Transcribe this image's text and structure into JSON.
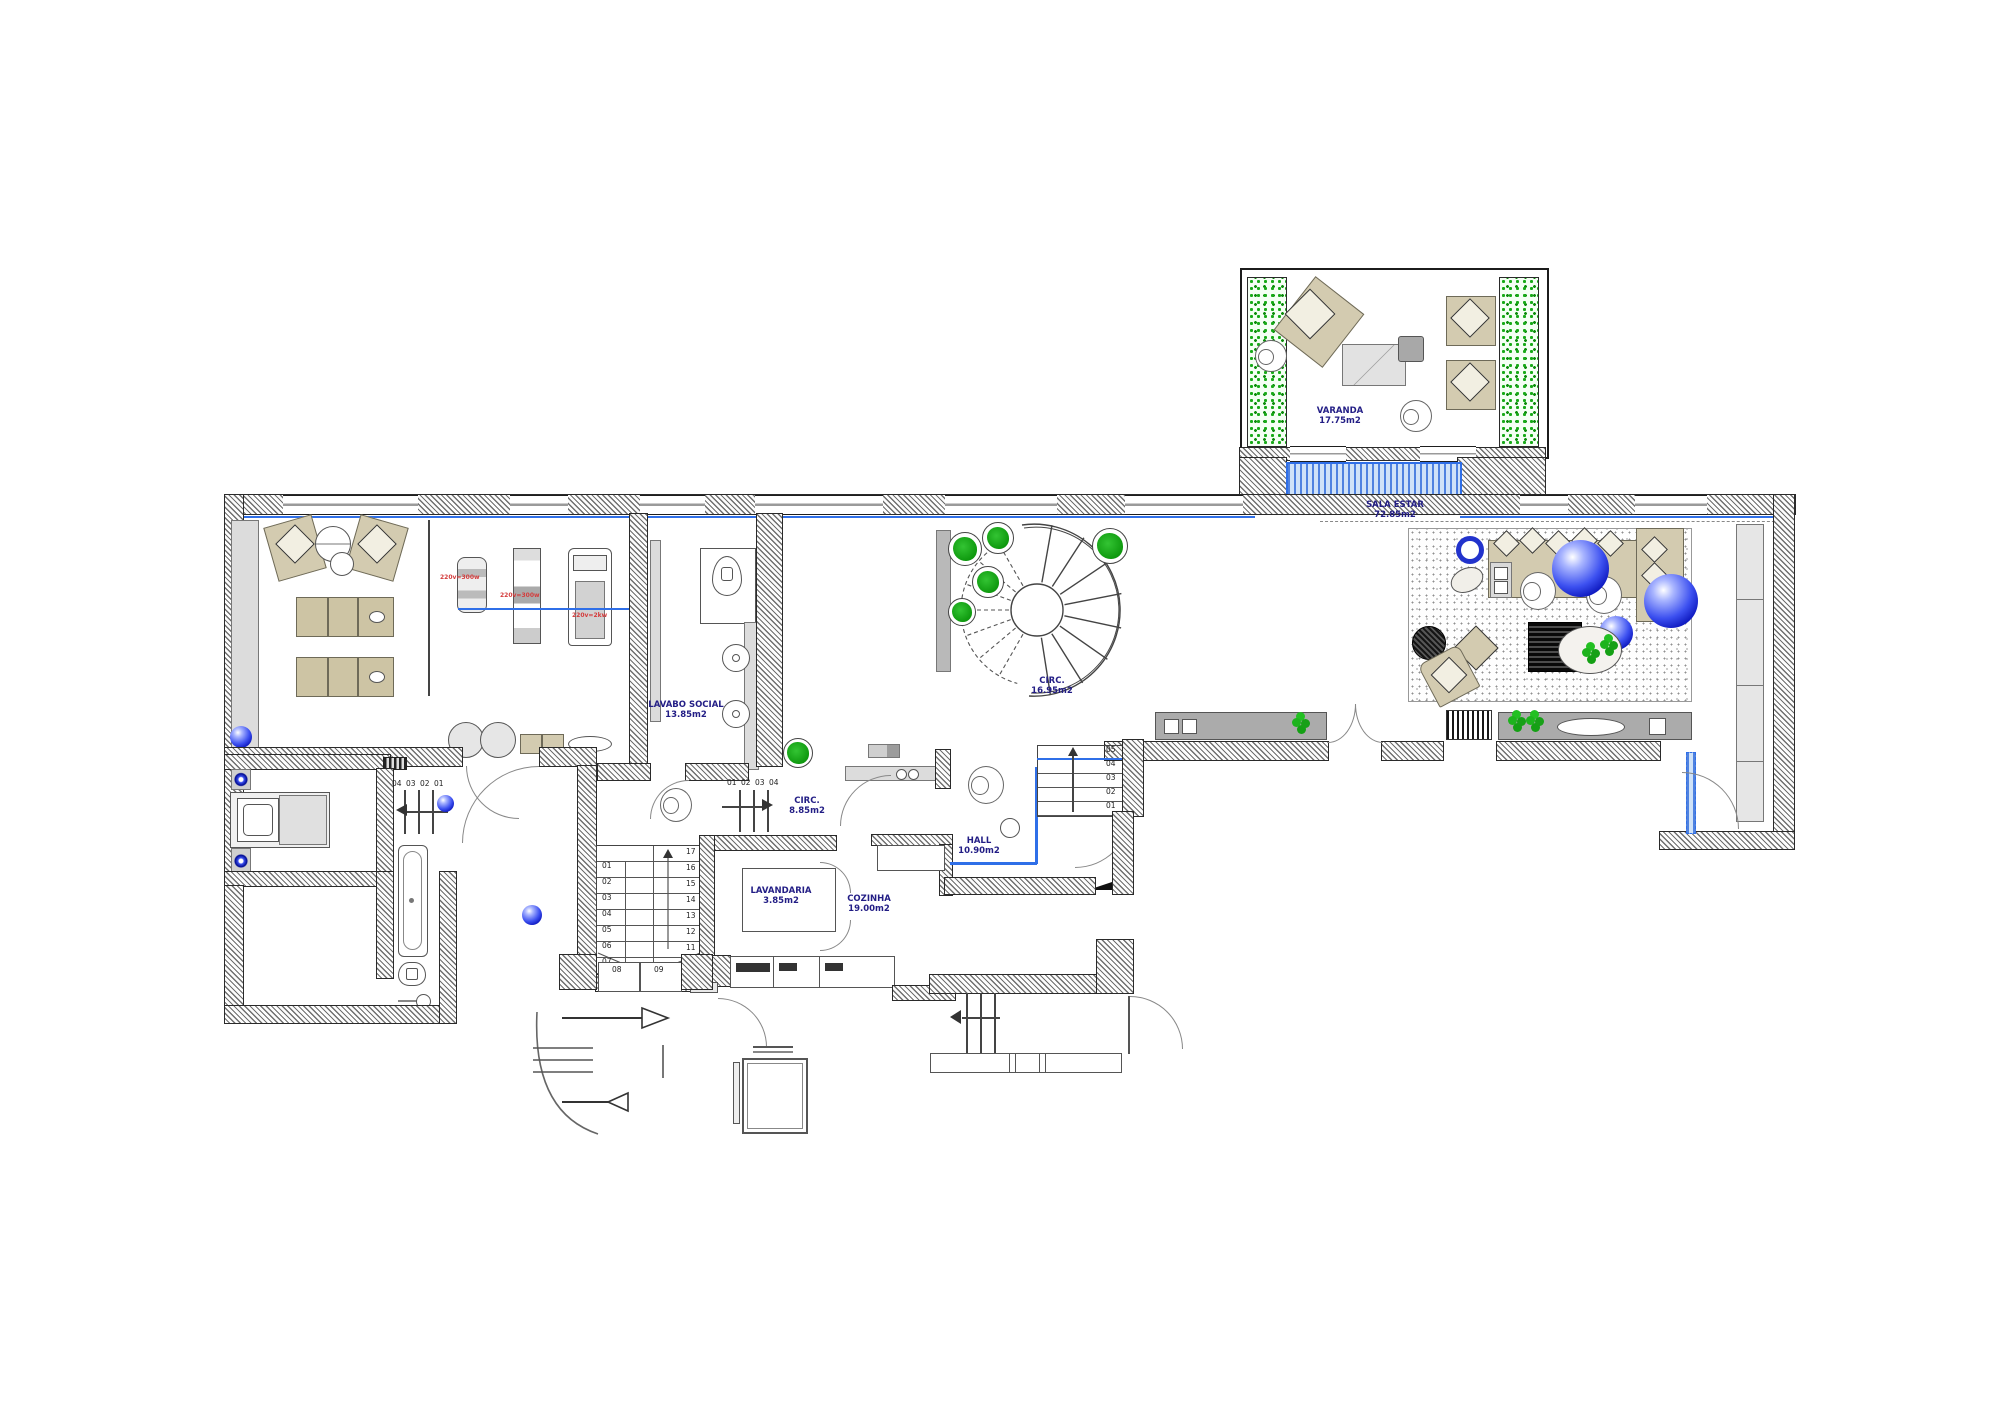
{
  "drawing": {
    "type": "residential floor plan, ground floor"
  },
  "rooms": {
    "varanda": {
      "name": "VARANDA",
      "area": "17.75m2"
    },
    "sala_estar": {
      "name": "SALA ESTAR",
      "area": "72.85m2"
    },
    "circ_main": {
      "name": "CIRC.",
      "area": "16.95m2"
    },
    "lavabo_social": {
      "name": "LAVABO SOCIAL",
      "area": "13.85m2"
    },
    "circ_small": {
      "name": "CIRC.",
      "area": "8.85m2"
    },
    "lavandaria": {
      "name": "LAVANDARIA",
      "area": "3.85m2"
    },
    "hall": {
      "name": "HALL",
      "area": "10.90m2"
    },
    "cozinha": {
      "name": "COZINHA",
      "area": "19.00m2"
    }
  },
  "equipment": {
    "bike_power": "220v=300w",
    "machine_power": "220v=300w",
    "treadmill_power": "220v=2kw"
  },
  "stairs": {
    "main": {
      "left": [
        "01",
        "02",
        "03",
        "04",
        "05",
        "06",
        "07"
      ],
      "right": [
        "17",
        "16",
        "15",
        "14",
        "13",
        "12",
        "11",
        "10"
      ]
    },
    "hall_flight": [
      "05",
      "04",
      "03",
      "02",
      "01"
    ],
    "circ_flight": [
      "01",
      "02",
      "03",
      "04"
    ],
    "bedroom_flight": [
      "04",
      "03",
      "02",
      "01"
    ],
    "exterior": [
      "08",
      "09"
    ]
  },
  "colors": {
    "label_navy": "#221d85",
    "window_blue": "#2f6fe8",
    "plant_green": "#1db31d",
    "sphere_blue": "#2334e0",
    "furniture_tan": "#d3cbb0",
    "red_note": "#d43c3c"
  }
}
